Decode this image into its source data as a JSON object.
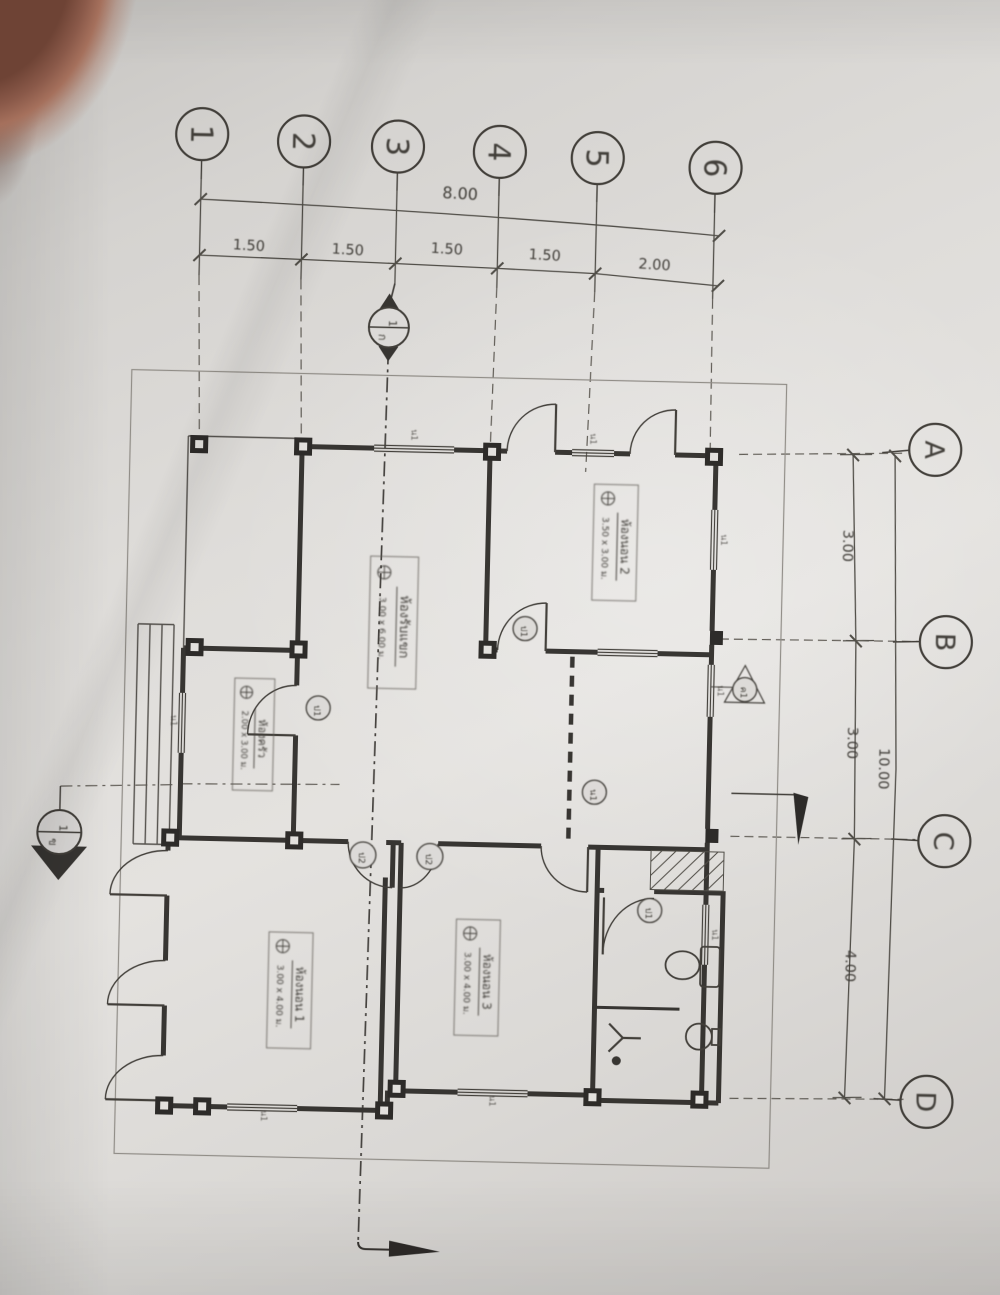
{
  "grid": {
    "top_bubbles": [
      "1",
      "2",
      "3",
      "4",
      "5",
      "6"
    ],
    "right_bubbles": [
      "A",
      "B",
      "C",
      "D"
    ]
  },
  "dims": {
    "top_total": "8.00",
    "top_segs": [
      "1.50",
      "1.50",
      "1.50",
      "1.50",
      "2.00"
    ],
    "right_total": "10.00",
    "right_segs": [
      "3.00",
      "3.00",
      "4.00"
    ]
  },
  "rooms": {
    "bedroom2": {
      "name": "ห้องนอน 2",
      "size": "3.50 x 3.00 ม."
    },
    "living": {
      "name": "ห้องรับแขก",
      "size": "3.00 x 6.00 ม."
    },
    "kitchen": {
      "name": "ห้องครัว",
      "size": "2.00 x 3.00 ม."
    },
    "bedroom1": {
      "name": "ห้องนอน 1",
      "size": "3.00 x 4.00 ม."
    },
    "bedroom3": {
      "name": "ห้องนอน 3",
      "size": "3.00 x 4.00 ม."
    }
  },
  "tags": {
    "door": "ป1",
    "door2": "ป2",
    "window": "น1",
    "column": "ค1"
  },
  "sections": {
    "top_marker": {
      "upper": "1",
      "lower": "ก"
    },
    "left_marker": {
      "upper": "1",
      "lower": "ข"
    }
  },
  "colors": {
    "ink": "#35322d",
    "wall": "#2a2724",
    "paper": "#dcdad7"
  }
}
